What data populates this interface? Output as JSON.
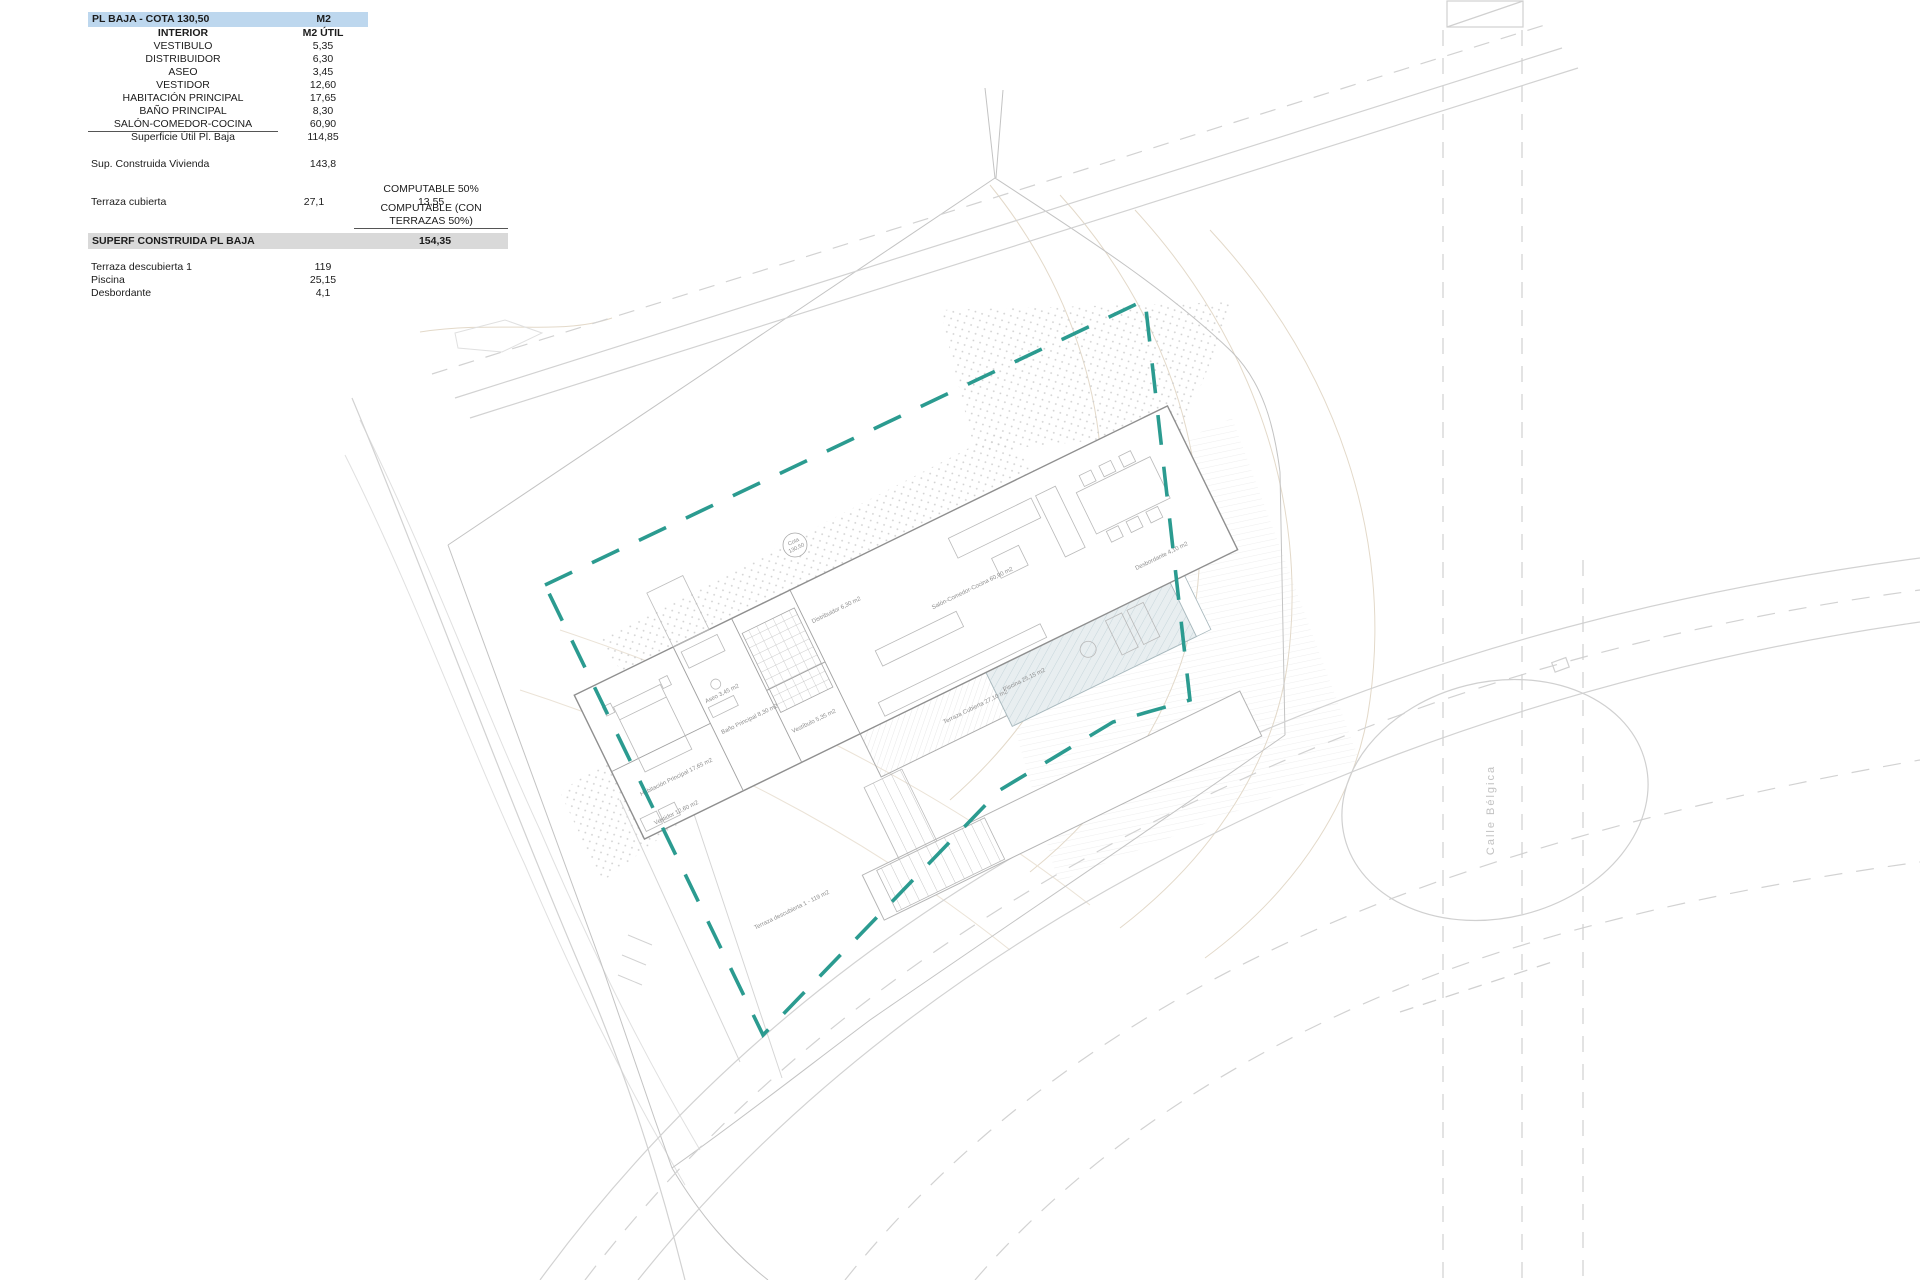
{
  "table": {
    "header": {
      "title": "PL BAJA - COTA 130,50",
      "col": "M2"
    },
    "subheader": {
      "label": "INTERIOR",
      "col": "M2 ÚTIL"
    },
    "rooms": [
      {
        "label": "VESTIBULO",
        "value": "5,35"
      },
      {
        "label": "DISTRIBUIDOR",
        "value": "6,30"
      },
      {
        "label": "ASEO",
        "value": "3,45"
      },
      {
        "label": "VESTIDOR",
        "value": "12,60"
      },
      {
        "label": "HABITACIÓN PRINCIPAL",
        "value": "17,65"
      },
      {
        "label": "BAÑO PRINCIPAL",
        "value": "8,30"
      },
      {
        "label": "SALÓN-COMEDOR-COCINA",
        "value": "60,90"
      }
    ],
    "subtotal": {
      "label": "Superficie Útil Pl. Baja",
      "value": "114,85"
    },
    "built": {
      "label": "Sup. Construida Vivienda",
      "value": "143,8"
    },
    "computable": {
      "line1": "COMPUTABLE 50%",
      "value": "13,55",
      "line2": "COMPUTABLE (CON TERRAZAS 50%)"
    },
    "terrace": {
      "label": "Terraza cubierta",
      "value": "27,1"
    },
    "total": {
      "label": "SUPERF CONSTRUIDA PL BAJA",
      "value": "154,35"
    },
    "extras": [
      {
        "label": "Terraza descubierta 1",
        "value": "119"
      },
      {
        "label": "Piscina",
        "value": "25,15"
      },
      {
        "label": "Desbordante",
        "value": "4,1"
      }
    ]
  },
  "plan": {
    "labels": {
      "vestibulo": "Vestíbulo 5,35 m2",
      "aseo": "Aseo 3,45 m2",
      "distribuidor": "Distribuidor 6,30 m2",
      "salon": "Salón-Comedor-Cocina 60,90 m2",
      "terraza_cubierta": "Terraza Cubierta 27,10 m2",
      "habitacion": "Habitación Principal 17,65 m2",
      "bano": "Baño Principal 8,30 m2",
      "vestidor": "Vestidor 12,60 m2",
      "terraza_descubierta": "Terraza descubierta 1 - 119 m2",
      "piscina": "Piscina 25,15 m2",
      "desbordante": "Desbordante 4,10 m2",
      "cota1": "Cota",
      "cota2": "130,50",
      "street": "Calle Bélgica"
    },
    "colors": {
      "boundary_teal": "#2b9b90",
      "header_blue": "#bdd7ee",
      "total_gray": "#d9d9d9",
      "pool_fill": "#e8eef0",
      "contour_tan": "#e3d9c9",
      "line_gray": "#c3c3c3"
    }
  }
}
